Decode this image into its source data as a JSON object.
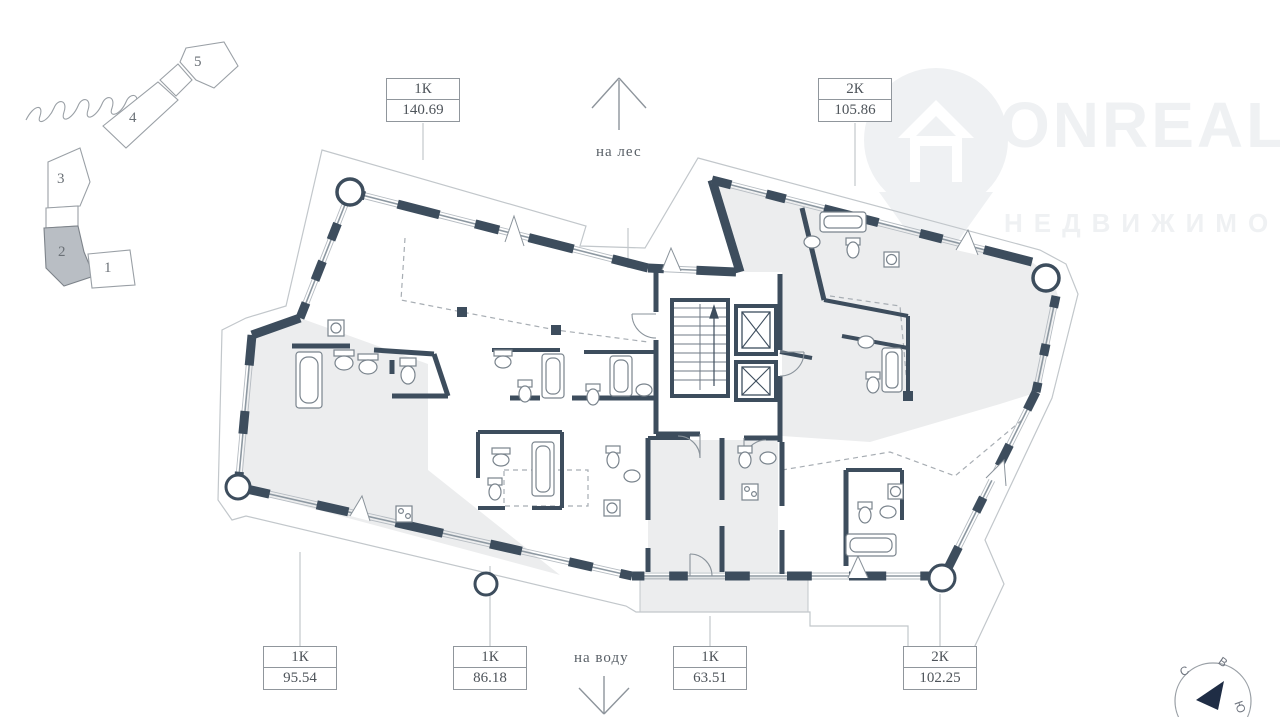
{
  "watermark": {
    "brand": "ONREALT",
    "tagline": "НЕДВИЖИМОСТЬ"
  },
  "site_map": {
    "buildings": [
      {
        "label": "1"
      },
      {
        "label": "2"
      },
      {
        "label": "3"
      },
      {
        "label": "4"
      },
      {
        "label": "5"
      }
    ],
    "highlighted_building": "2"
  },
  "directions": {
    "top": "на лес",
    "bottom": "на воду"
  },
  "apartments": [
    {
      "type": "1К",
      "area": "140.69"
    },
    {
      "type": "2К",
      "area": "105.86"
    },
    {
      "type": "1К",
      "area": "95.54"
    },
    {
      "type": "1К",
      "area": "86.18"
    },
    {
      "type": "1К",
      "area": "63.51"
    },
    {
      "type": "2К",
      "area": "102.25"
    }
  ],
  "compass": {
    "letters": [
      {
        "char": "С"
      },
      {
        "char": "В"
      },
      {
        "char": "Ю"
      }
    ]
  },
  "colors": {
    "wall": "#3d4d5d",
    "room_fill": "#ecedee",
    "highlight": "#b9bec4",
    "watermark": "#eff1f3"
  }
}
